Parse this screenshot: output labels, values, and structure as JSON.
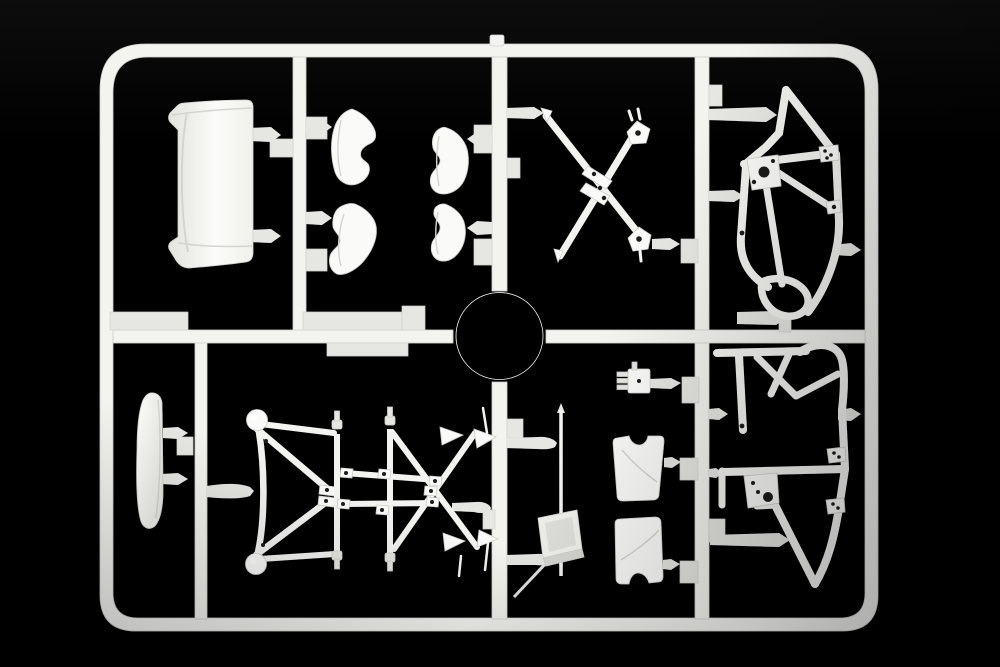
{
  "scene": {
    "type": "photograph",
    "subject": "injection-molded plastic model kit sprue (parts runner)",
    "description": "Unpainted white styrene sprue frame with racing-car model parts, photographed on a dark charcoal studio background with soft vignette",
    "visible_text": "none"
  },
  "colors": {
    "bg_center": "#2e2e2c",
    "bg_corner": "#0a0a09",
    "plastic": "#f3f3f0",
    "plastic_bright": "#fafaf8",
    "plastic_dim": "#e6e6e2",
    "plastic_edge": "#cfcfc9",
    "hole": "#1f1f1d"
  },
  "sprue": {
    "frame_shape": "rounded rectangle with one horizontal and four vertical runners, center alignment ring, molded identification tabs, injection gate stub at top center",
    "runner_count": 5,
    "molded_tab_count": 3,
    "parts": [
      {
        "id": "curved-panel",
        "label": "curved body panel / windscreen insert",
        "area": "top left"
      },
      {
        "id": "seat-shell-upper-left",
        "label": "curved shell half",
        "area": "top middle-left"
      },
      {
        "id": "seat-shell-lower-left",
        "label": "curved shell half",
        "area": "top middle-left"
      },
      {
        "id": "seat-shell-upper-right",
        "label": "curved shell half",
        "area": "top middle"
      },
      {
        "id": "seat-shell-lower-right",
        "label": "curved shell half",
        "area": "top middle"
      },
      {
        "id": "x-brace",
        "label": "X-shaped chassis cross brace with drilled pads",
        "area": "top center"
      },
      {
        "id": "roll-cage-upper",
        "label": "roll cage side frame with triangular pillar and drilled bosses",
        "area": "upper right"
      },
      {
        "id": "roll-cage-lower",
        "label": "roll cage side frame with looped top rail and drilled bosses",
        "area": "lower right"
      },
      {
        "id": "wing-element",
        "label": "narrow airfoil / wing element",
        "area": "lower left"
      },
      {
        "id": "ball-truss",
        "label": "triangulated link with two ball ends",
        "area": "bottom middle-left"
      },
      {
        "id": "lattice-truss",
        "label": "crossed-bar suspension lattice with arrow tips",
        "area": "bottom middle"
      },
      {
        "id": "pushrod-1",
        "label": "vertical pushrod with stepped connectors",
        "area": "bottom middle"
      },
      {
        "id": "pushrod-2",
        "label": "vertical pushrod with stepped connectors",
        "area": "bottom middle"
      },
      {
        "id": "antenna-rod-box",
        "label": "thin rod with tilted open box tray",
        "area": "bottom center"
      },
      {
        "id": "seat-back-upper",
        "label": "notched backrest panel",
        "area": "bottom center-right"
      },
      {
        "id": "seat-back-lower",
        "label": "notched backrest panel",
        "area": "bottom center-right"
      },
      {
        "id": "small-bracket",
        "label": "small pinned bracket",
        "area": "center right"
      },
      {
        "id": "alignment-ring",
        "label": "circular runner ring",
        "area": "center"
      }
    ]
  }
}
